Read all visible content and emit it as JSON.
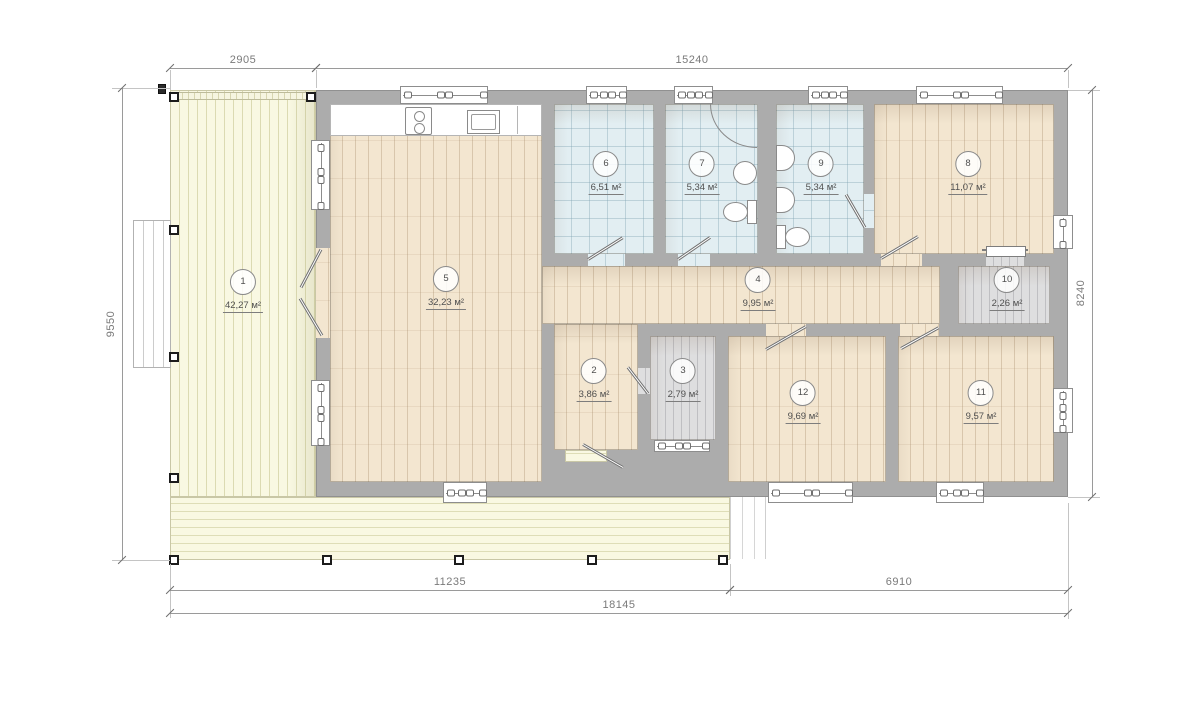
{
  "title": "single-storey house floor plan",
  "unit_suffix": "м²",
  "colors": {
    "wall": "#acacac",
    "wood_floor": "#f3e6d0",
    "tile_floor": "#e2eef2",
    "gray_floor": "#dededf",
    "deck_floor": "#f9f8e2",
    "dim_text": "#7a7a7a"
  },
  "building": {
    "rect": [
      316,
      90,
      752,
      407
    ]
  },
  "deck": {
    "left": [
      170,
      90,
      146,
      407
    ],
    "bottom_band": [
      170,
      497,
      560,
      63
    ],
    "porch": [
      553,
      462,
      163,
      35
    ],
    "edge_strip": [
      170,
      92,
      146,
      8
    ],
    "stairs": [
      133,
      220,
      38,
      148
    ],
    "side_steps": [
      730,
      497,
      36,
      62
    ]
  },
  "rooms": [
    {
      "num": "1",
      "area": "42,27",
      "floor": "none",
      "label": [
        243,
        291
      ]
    },
    {
      "num": "2",
      "area": "3,86",
      "floor": "wood",
      "rect": [
        554,
        324,
        84,
        126
      ],
      "label": [
        594,
        380
      ]
    },
    {
      "num": "3",
      "area": "2,79",
      "floor": "gray",
      "rect": [
        650,
        336,
        66,
        104
      ],
      "label": [
        683,
        380
      ]
    },
    {
      "num": "4",
      "area": "9,95",
      "floor": "wood",
      "rect": [
        542,
        266,
        398,
        58
      ],
      "label": [
        758,
        289
      ]
    },
    {
      "num": "5",
      "area": "32,23",
      "floor": "wood",
      "rect": [
        330,
        104,
        212,
        378
      ],
      "label": [
        446,
        288
      ]
    },
    {
      "num": "6",
      "area": "6,51",
      "floor": "tile",
      "rect": [
        554,
        104,
        100,
        150
      ],
      "label": [
        606,
        173
      ]
    },
    {
      "num": "7",
      "area": "5,34",
      "floor": "tile",
      "rect": [
        665,
        104,
        93,
        150
      ],
      "label": [
        702,
        173
      ]
    },
    {
      "num": "8",
      "area": "11,07",
      "floor": "wood",
      "rect": [
        874,
        104,
        180,
        150
      ],
      "label": [
        968,
        173
      ]
    },
    {
      "num": "9",
      "area": "5,34",
      "floor": "tile",
      "rect": [
        776,
        104,
        88,
        150
      ],
      "label": [
        821,
        173
      ]
    },
    {
      "num": "10",
      "area": "2,26",
      "floor": "gray",
      "rect": [
        958,
        266,
        92,
        58
      ],
      "label": [
        1007,
        289
      ]
    },
    {
      "num": "11",
      "area": "9,57",
      "floor": "wood",
      "rect": [
        898,
        336,
        156,
        146
      ],
      "label": [
        981,
        402
      ]
    },
    {
      "num": "12",
      "area": "9,69",
      "floor": "wood",
      "rect": [
        728,
        336,
        158,
        146
      ],
      "label": [
        803,
        402
      ]
    }
  ],
  "openings": [
    {
      "floor": "wood",
      "rect": [
        316,
        248,
        14,
        90
      ]
    },
    {
      "floor": "tile",
      "rect": [
        588,
        254,
        37,
        12
      ]
    },
    {
      "floor": "tile",
      "rect": [
        678,
        254,
        32,
        12
      ]
    },
    {
      "floor": "tile",
      "rect": [
        864,
        194,
        10,
        34
      ]
    },
    {
      "floor": "wood",
      "rect": [
        881,
        254,
        41,
        12
      ]
    },
    {
      "floor": "gray",
      "rect": [
        986,
        254,
        38,
        12
      ]
    },
    {
      "floor": "gray",
      "rect": [
        638,
        368,
        12,
        26
      ]
    },
    {
      "floor": "wood",
      "rect": [
        766,
        324,
        40,
        12
      ]
    },
    {
      "floor": "wood",
      "rect": [
        900,
        324,
        39,
        12
      ]
    },
    {
      "floor": "deck-h",
      "rect": [
        565,
        450,
        42,
        12
      ]
    }
  ],
  "windows": [
    {
      "o": "h",
      "rect": [
        400,
        86,
        88,
        18
      ]
    },
    {
      "o": "h",
      "rect": [
        586,
        86,
        41,
        18
      ]
    },
    {
      "o": "h",
      "rect": [
        674,
        86,
        39,
        18
      ]
    },
    {
      "o": "h",
      "rect": [
        808,
        86,
        40,
        18
      ]
    },
    {
      "o": "h",
      "rect": [
        916,
        86,
        87,
        18
      ]
    },
    {
      "o": "h",
      "rect": [
        443,
        482,
        44,
        21
      ]
    },
    {
      "o": "h",
      "rect": [
        768,
        482,
        85,
        21
      ]
    },
    {
      "o": "h",
      "rect": [
        936,
        482,
        48,
        21
      ]
    },
    {
      "o": "h",
      "rect": [
        654,
        440,
        56,
        12
      ]
    },
    {
      "o": "v",
      "rect": [
        311,
        140,
        19,
        70
      ]
    },
    {
      "o": "v",
      "rect": [
        311,
        380,
        19,
        66
      ]
    },
    {
      "o": "v",
      "rect": [
        1053,
        215,
        20,
        34
      ]
    },
    {
      "o": "v",
      "rect": [
        1053,
        388,
        20,
        45
      ]
    }
  ],
  "doors": [
    {
      "name": "deck-door-upper-leaf",
      "line": [
        321,
        250,
        301,
        288
      ]
    },
    {
      "name": "deck-door-lower-leaf",
      "line": [
        322,
        336,
        300,
        299
      ]
    },
    {
      "name": "room6-door-leaf",
      "line": [
        588,
        260,
        623,
        238
      ]
    },
    {
      "name": "room7-door-leaf",
      "line": [
        678,
        260,
        710,
        238
      ]
    },
    {
      "name": "room9-door-leaf",
      "line": [
        865,
        228,
        846,
        195
      ]
    },
    {
      "name": "room8-door-leaf",
      "line": [
        881,
        259,
        918,
        237
      ]
    },
    {
      "name": "room3-door-leaf",
      "line": [
        648,
        394,
        628,
        368
      ]
    },
    {
      "name": "room12-door-leaf",
      "line": [
        766,
        350,
        806,
        327
      ]
    },
    {
      "name": "room11-door-leaf",
      "line": [
        901,
        349,
        939,
        328
      ]
    },
    {
      "name": "entry-door-leaf",
      "line": [
        583,
        445,
        623,
        468
      ]
    }
  ],
  "slider": {
    "rail": [
      982,
      249,
      46,
      2
    ],
    "panel": [
      986,
      246,
      40,
      11
    ]
  },
  "fixtures": {
    "kitchen_counter": [
      330,
      104,
      212,
      32
    ],
    "counter_divider": [
      517,
      106,
      1,
      28
    ],
    "stove": [
      405,
      107,
      27,
      28
    ],
    "kitchen_sink": [
      467,
      110,
      33,
      24
    ],
    "shower_arc": [
      710,
      104,
      47,
      44
    ],
    "bath7_sink": [
      733,
      161,
      24,
      24
    ],
    "bath7_toilet_tank": [
      747,
      200,
      10,
      24
    ],
    "bath7_toilet_bowl": [
      723,
      202,
      25,
      20
    ],
    "bath9_sink_a": [
      776,
      145,
      19,
      26
    ],
    "bath9_sink_b": [
      776,
      187,
      19,
      26
    ],
    "bath9_toilet_tank": [
      776,
      225,
      10,
      24
    ],
    "bath9_toilet_bowl": [
      785,
      227,
      25,
      20
    ]
  },
  "posts": [
    [
      174,
      97
    ],
    [
      311,
      97
    ],
    [
      174,
      230
    ],
    [
      174,
      357
    ],
    [
      174,
      478
    ],
    [
      174,
      560
    ],
    [
      327,
      560
    ],
    [
      459,
      560
    ],
    [
      592,
      560
    ],
    [
      723,
      560
    ]
  ],
  "dark_marker": [
    162,
    89,
    8,
    10
  ],
  "dimensions": [
    {
      "o": "h",
      "label": "2905",
      "x1": 170,
      "x2": 316,
      "y": 68,
      "tx": 243,
      "ty": 66
    },
    {
      "o": "h",
      "label": "15240",
      "x1": 316,
      "x2": 1068,
      "y": 68,
      "tx": 692,
      "ty": 66
    },
    {
      "o": "v",
      "label": "9550",
      "y1": 88,
      "y2": 560,
      "x": 122,
      "tx": 111,
      "ty": 324
    },
    {
      "o": "v",
      "label": "8240",
      "y1": 90,
      "y2": 497,
      "x": 1092,
      "tx": 1081,
      "ty": 293
    },
    {
      "o": "h",
      "label": "11235",
      "x1": 170,
      "x2": 730,
      "y": 590,
      "tx": 450,
      "ty": 588
    },
    {
      "o": "h",
      "label": "6910",
      "x1": 730,
      "x2": 1068,
      "y": 590,
      "tx": 899,
      "ty": 588
    },
    {
      "o": "h",
      "label": "18145",
      "x1": 170,
      "x2": 1068,
      "y": 613,
      "tx": 619,
      "ty": 611
    }
  ],
  "extension_lines": [
    [
      170,
      70,
      1,
      20
    ],
    [
      316,
      70,
      1,
      18
    ],
    [
      1068,
      70,
      1,
      18
    ],
    [
      112,
      88,
      58,
      1
    ],
    [
      112,
      560,
      58,
      1
    ],
    [
      1068,
      90,
      32,
      1
    ],
    [
      1068,
      497,
      32,
      1
    ],
    [
      170,
      564,
      1,
      54
    ],
    [
      730,
      564,
      1,
      32
    ],
    [
      1068,
      503,
      1,
      116
    ]
  ]
}
